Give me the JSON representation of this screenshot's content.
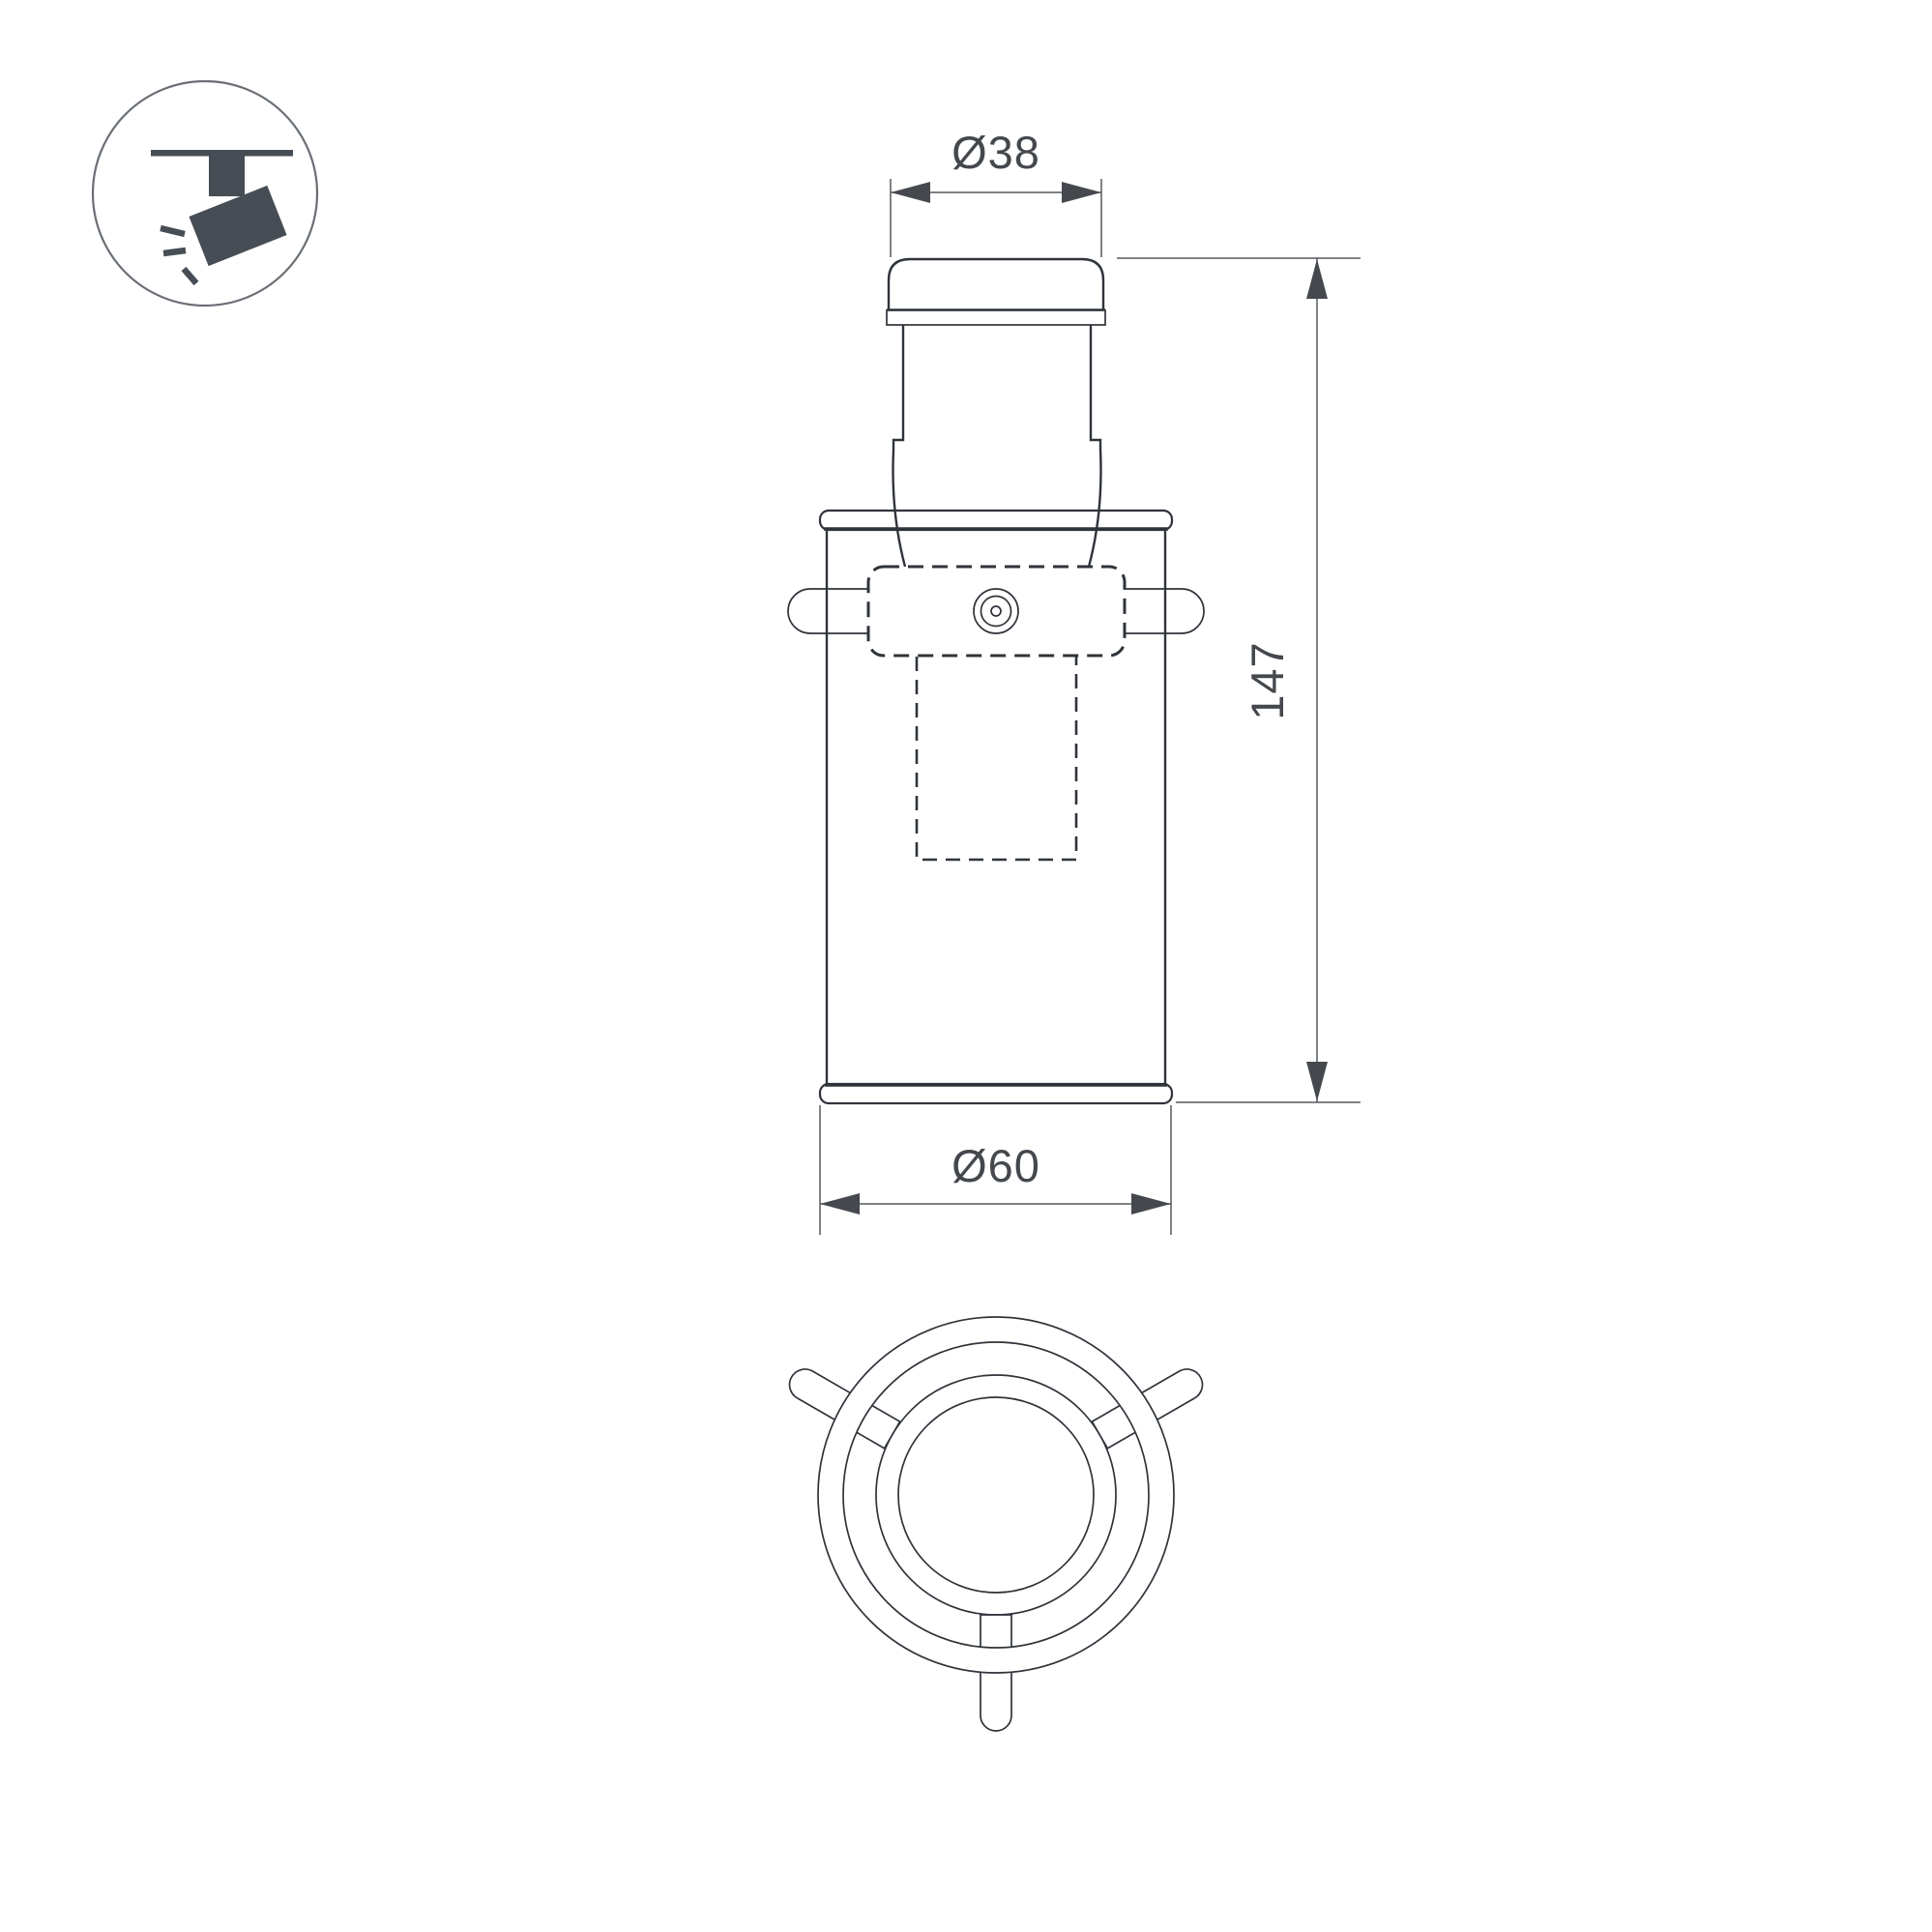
{
  "page": {
    "background": "#ffffff"
  },
  "badge": {
    "icon": "track-spotlight-icon"
  },
  "dimensions": {
    "top_diameter": "Ø38",
    "height": "147",
    "bottom_diameter": "Ø60"
  },
  "colors": {
    "outline": "#2f343a",
    "dimension_line": "#55585d",
    "dimension_text": "#44484d",
    "arrow": "#45494e",
    "icon": "#474d54",
    "icon_ring": "#6a6f75"
  }
}
